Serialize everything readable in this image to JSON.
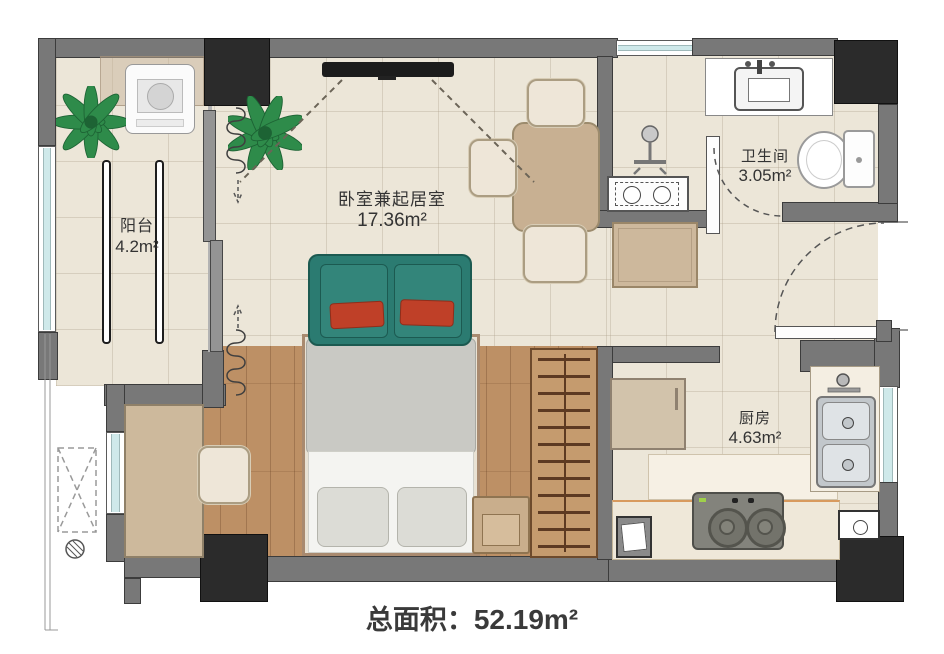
{
  "plan": {
    "rooms": [
      {
        "id": "balcony",
        "name": "阳台",
        "area": "4.2m²"
      },
      {
        "id": "bedroom_living",
        "name": "卧室兼起居室",
        "area": "17.36m²"
      },
      {
        "id": "bathroom",
        "name": "卫生间",
        "area": "3.05m²"
      },
      {
        "id": "kitchen",
        "name": "厨房",
        "area": "4.63m²"
      }
    ],
    "caption": {
      "label": "总面积：",
      "value": "52.19m²"
    },
    "colors": {
      "wall": "#787878",
      "pillar": "#2b2b2b",
      "tile_floor": "#ece6d8",
      "wood_floor": "#bd9065",
      "window_glass": "#cfe9ea",
      "sofa_teal": "#2b7b71",
      "pillow_red": "#bf4028",
      "counter_cream": "#f2ecdf",
      "stove_gray": "#83837c"
    }
  }
}
